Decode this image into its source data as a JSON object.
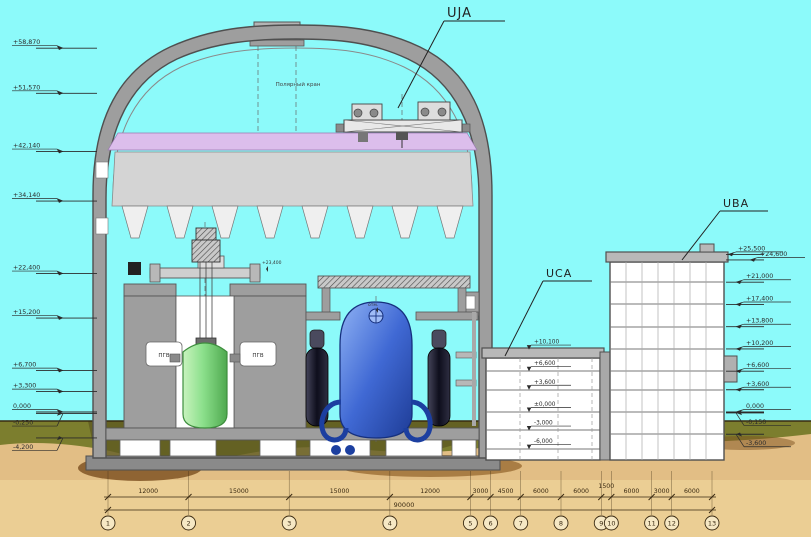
{
  "labels": {
    "uja": "UJA",
    "uca": "UCA",
    "uba": "UBA"
  },
  "containment": {
    "hall_text": "Полярный кран"
  },
  "equipment": {
    "pgv": "ПГВ",
    "level_note": "+23,400",
    "otm_note": "отм."
  },
  "elevations": {
    "left": [
      "+58,870",
      "+51,570",
      "+42,140",
      "+34,140",
      "+22,400",
      "+15,200",
      "+6,700",
      "+3,300",
      "0,000",
      "-0,250",
      "-4,200"
    ],
    "right": [
      "+25,500",
      "+24,600",
      "+21,000",
      "+17,400",
      "+13,800",
      "+10,200",
      "+6,600",
      "+3,600",
      "0,000",
      "-0,150",
      "-3,600"
    ],
    "uca": [
      "+10,100",
      "+6,600",
      "+3,600",
      "±0,000",
      "-3,000",
      "-6,000"
    ]
  },
  "dimensions": {
    "segments": [
      "12000",
      "15000",
      "15000",
      "12000",
      "3000",
      "4500",
      "6000",
      "6000",
      "1500",
      "6000",
      "3000",
      "6000"
    ],
    "total": "90000"
  },
  "axes": [
    "1",
    "2",
    "3",
    "4",
    "5",
    "6",
    "7",
    "8",
    "9",
    "10",
    "11",
    "12",
    "13"
  ],
  "colors": {
    "sky": "#8CFAFA",
    "sand": "#E2BE85",
    "sand_light": "#ECD196",
    "olive": "#7C7E2E",
    "earth_brown": "#7A4E1E",
    "wall_gray": "#9E9E9E",
    "band_purple": "#DCBEEC",
    "zone_gray": "#D4D4D4",
    "reactor_green": "#8CE08C",
    "vessel_blue": "#3F69D2",
    "pipe_navy": "#1C3FA0",
    "dim_brown": "#3A2A12",
    "marker_ink": "#2B2B2B"
  }
}
